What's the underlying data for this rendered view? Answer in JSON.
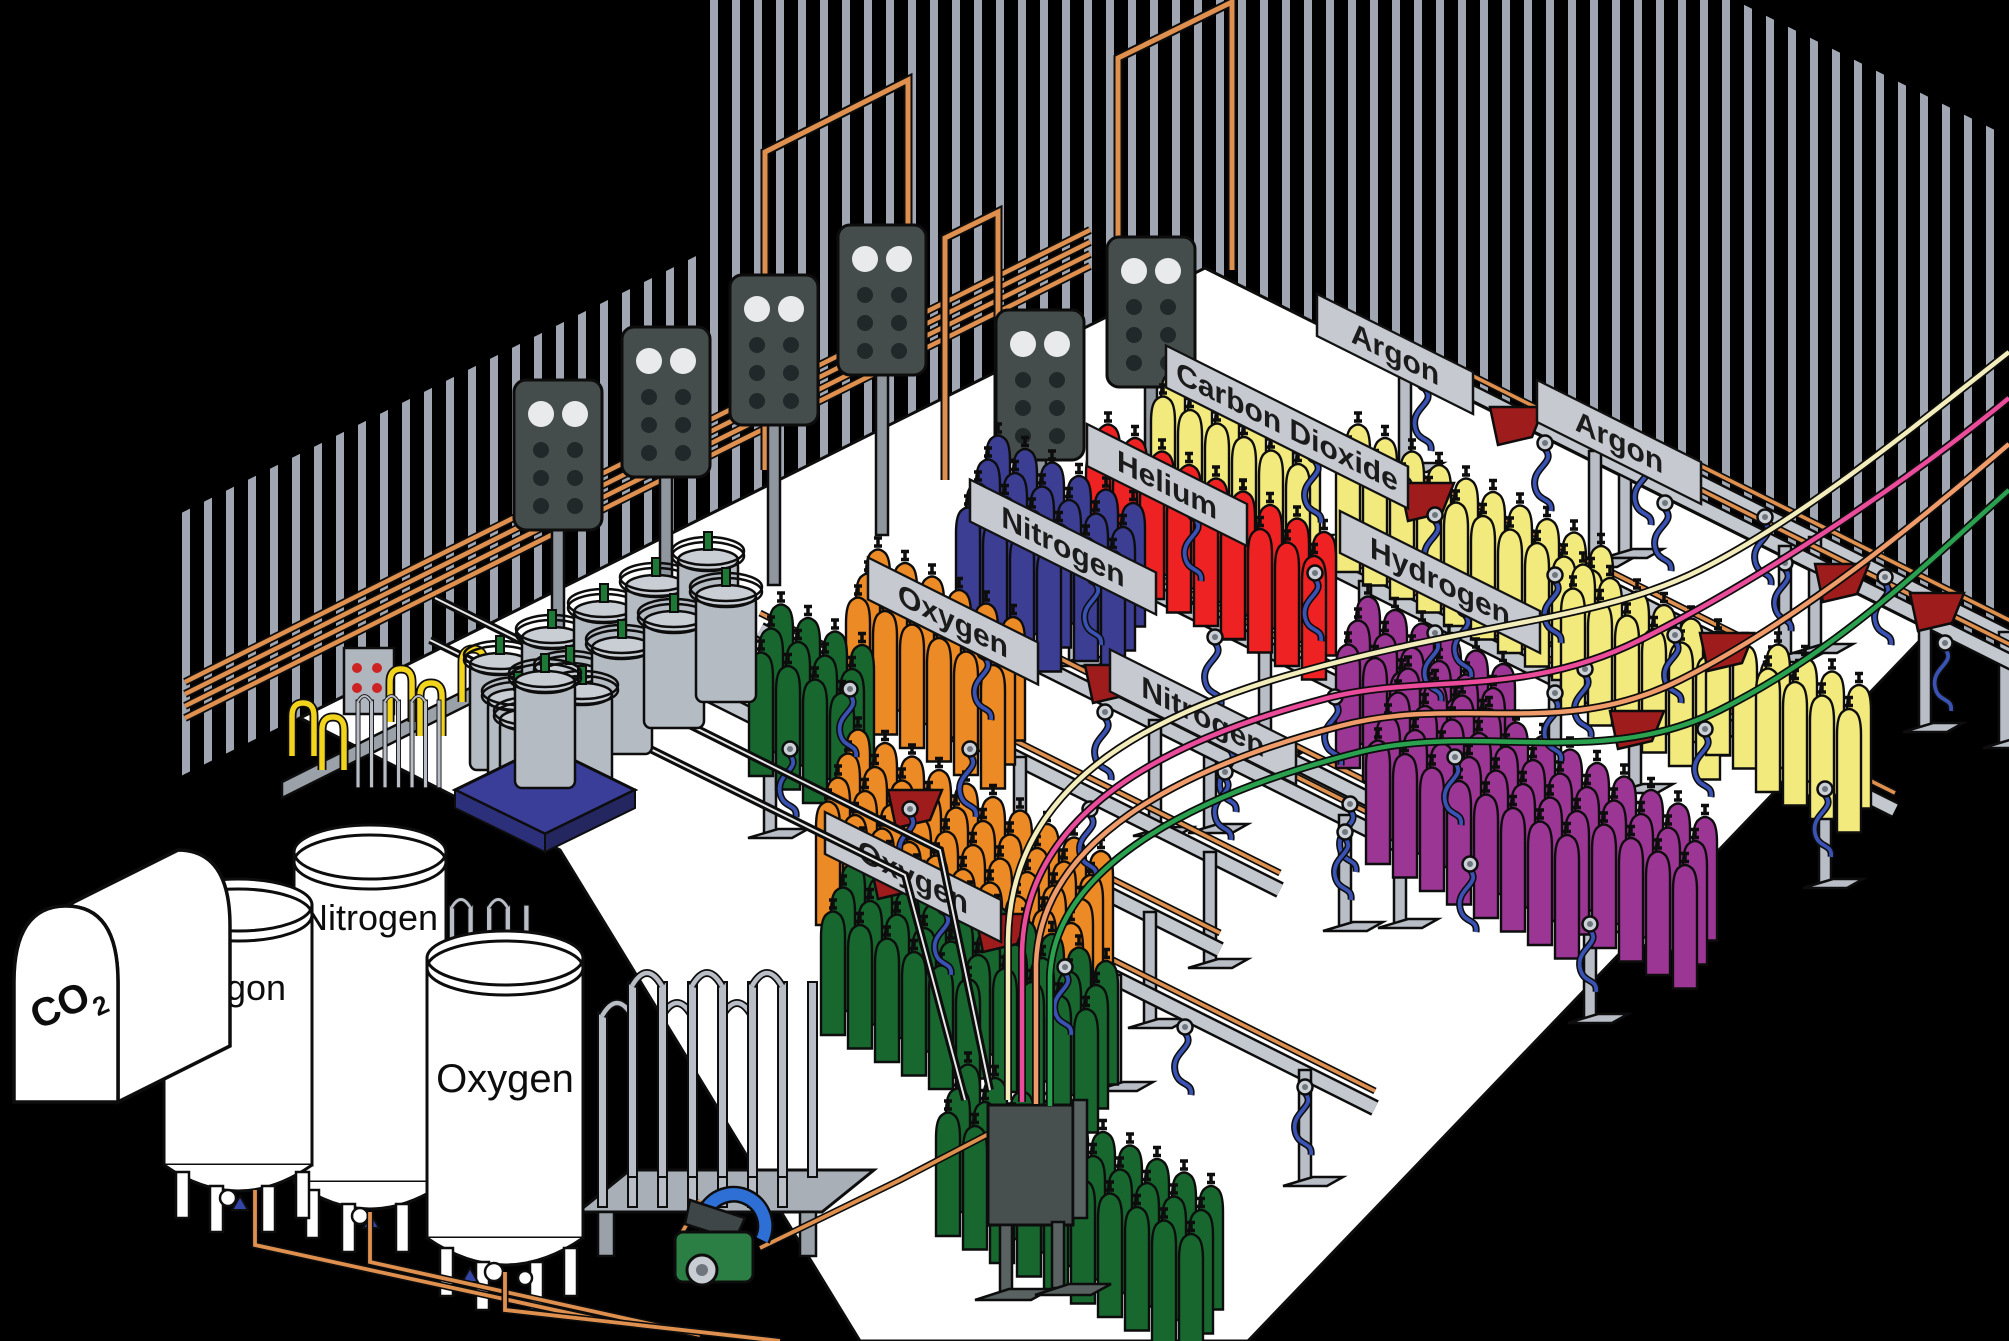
{
  "scene": {
    "type": "isometric cutaway illustration",
    "subject": "Industrial gas cylinder filling plant"
  },
  "bulk_storage": {
    "co2_tank": {
      "label_base": "CO",
      "label_sub": "2"
    },
    "argon_tank_label": "Argon",
    "nitrogen_tank_label": "Nitrogen",
    "oxygen_tank_label": "Oxygen"
  },
  "filling_racks": {
    "signs": {
      "oxygen_upper": "Oxygen",
      "nitrogen_upper": "Nitrogen",
      "helium": "Helium",
      "carbon_dioxide": "Carbon Dioxide",
      "argon_back": "Argon",
      "argon_right": "Argon",
      "hydrogen": "Hydrogen",
      "nitrogen_mid": "Nitrogen",
      "oxygen_lower": "Oxygen"
    }
  },
  "colors": {
    "background": "#000000",
    "floor": "#ffffff",
    "wall_stripe": "#a0a7b2",
    "copper_pipe": "#e0904e",
    "rail_gray": "#c3c8ce",
    "sign_plate": "#c6cad0",
    "hose_blue": "#3952b4",
    "hose_yellow": "#f3d41c",
    "flag_red": "#9e1c1c",
    "gas_line_cream": "#f2edbb",
    "gas_line_pink": "#ea4b9b",
    "gas_line_salmon": "#f09b6a",
    "gas_line_green": "#2aa14e",
    "cylinder_oxygen_green": "#17672f",
    "cylinder_nitrogen_blue": "#3b3e92",
    "cylinder_orange": "#ec8a25",
    "cylinder_helium_red": "#ee2222",
    "cylinder_yellow": "#f2ea7d",
    "cylinder_hydrogen_purple": "#9c3694",
    "manifold_panel_dark": "#454d4c",
    "scale_blue": "#3a3e99",
    "pump_green": "#2c7f44",
    "pump_hose_blue": "#2e6fd6"
  }
}
